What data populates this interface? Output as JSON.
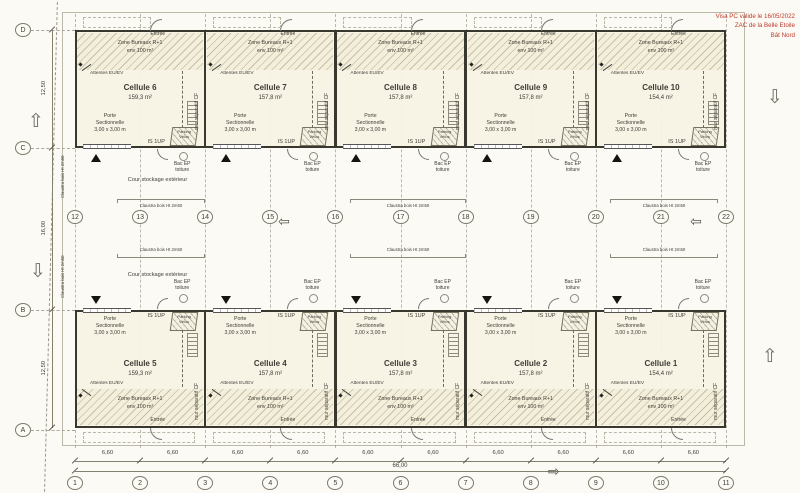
{
  "title_stamp": {
    "color": "#bf3a2b",
    "lines": [
      "Visa PC valide le 16/05/2022",
      "ZAC de la Belle Etoile",
      "Bât Nord"
    ]
  },
  "grid": {
    "top_numbers": [
      "12",
      "13",
      "14",
      "15",
      "16",
      "17",
      "18",
      "19",
      "20",
      "21",
      "22"
    ],
    "bottom_numbers": [
      "1",
      "2",
      "3",
      "4",
      "5",
      "6",
      "7",
      "8",
      "9",
      "10",
      "11"
    ],
    "row_letters": [
      "D",
      "C",
      "B",
      "A"
    ],
    "bay_width": "6,60",
    "total_width": "66,00",
    "row_spans": [
      "12,50",
      "16,00",
      "12,50"
    ]
  },
  "cells_top": [
    {
      "name": "Cellule 6",
      "area": "159,3 m²"
    },
    {
      "name": "Cellule 7",
      "area": "157,8 m²"
    },
    {
      "name": "Cellule 8",
      "area": "157,8 m²"
    },
    {
      "name": "Cellule 9",
      "area": "157,8 m²"
    },
    {
      "name": "Cellule 10",
      "area": "154,4 m²"
    }
  ],
  "cells_bottom": [
    {
      "name": "Cellule 5",
      "area": "159,3 m²"
    },
    {
      "name": "Cellule 4",
      "area": "157,8 m²"
    },
    {
      "name": "Cellule 3",
      "area": "157,8 m²"
    },
    {
      "name": "Cellule 2",
      "area": "157,8 m²"
    },
    {
      "name": "Cellule 1",
      "area": "154,4 m²"
    }
  ],
  "labels": {
    "zone1": "Zone Bureaux R+1",
    "zone2": "env 100 m²",
    "entree": "Entrée",
    "attentes": "Attentes EU/EV",
    "porte1": "Porte",
    "porte2": "Sectionnelle",
    "porte3": "3,00 x 3,00 m",
    "is1up": "IS 1UP",
    "parking1": "Parking",
    "parking2": "Vélos",
    "mur": "mur séparatif CF",
    "bac1": "Bac EP",
    "bac2": "toiture",
    "cour": "Cour stockage extérieur",
    "claustra": "Claustra bois Ht 2m50"
  }
}
